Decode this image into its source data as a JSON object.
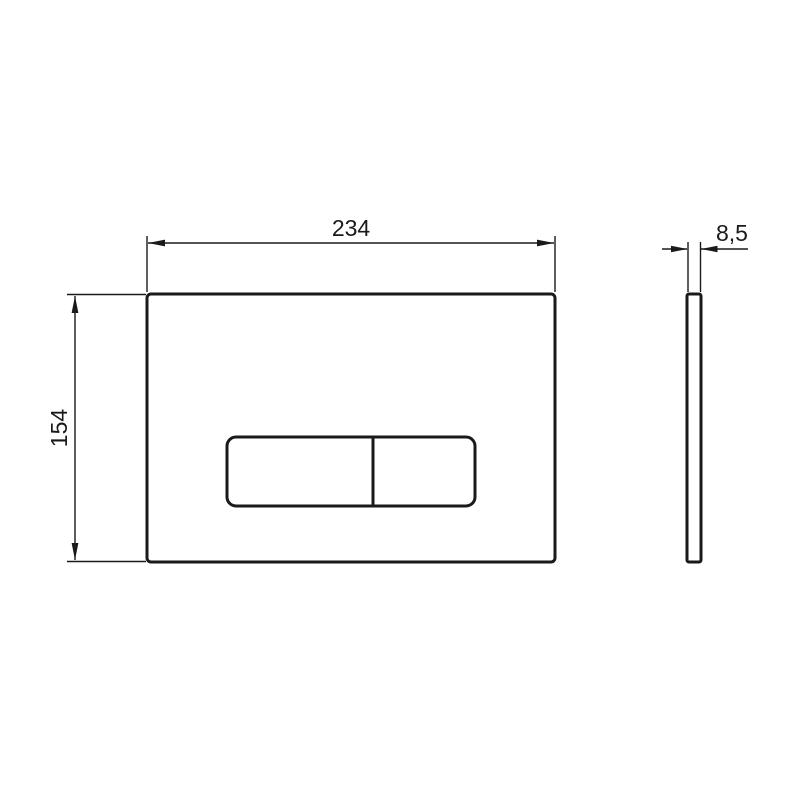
{
  "drawing": {
    "kind": "flush-plate-technical-drawing",
    "dimensions": {
      "width_label": "234",
      "height_label": "154",
      "depth_label": "8,5"
    },
    "colors": {
      "line": "#1a1a1a",
      "background": "#ffffff"
    }
  }
}
